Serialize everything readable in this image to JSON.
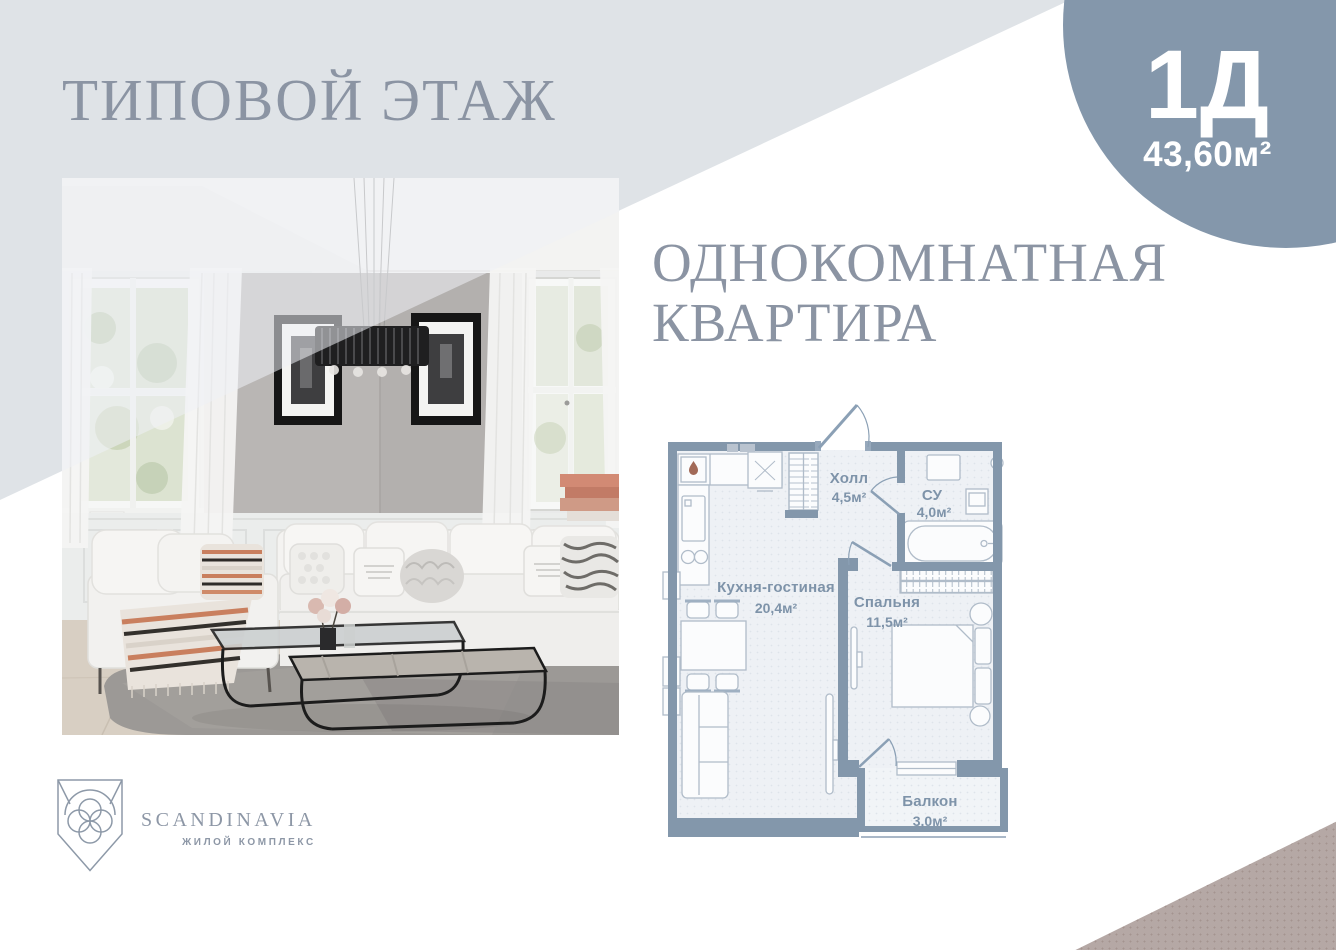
{
  "header": {
    "floor_title": "ТИПОВОЙ ЭТАЖ",
    "apartment_line1": "ОДНОКОМНАТНАЯ",
    "apartment_line2": "КВАРТИРА"
  },
  "badge": {
    "unit": "1Д",
    "area": "43,60м²"
  },
  "plan": {
    "rooms": [
      {
        "name": "Кухня-гостиная",
        "area": "20,4м²"
      },
      {
        "name": "Холл",
        "area": "4,5м²"
      },
      {
        "name": "СУ",
        "area": "4,0м²"
      },
      {
        "name": "Спальня",
        "area": "11,5м²"
      },
      {
        "name": "Балкон",
        "area": "3,0м²"
      }
    ]
  },
  "logo": {
    "name": "SCANDINAVIA",
    "tagline": "ЖИЛОЙ КОМПЛЕКС"
  },
  "colors": {
    "background_panel": "#dfe3e7",
    "badge_circle": "#8497ab",
    "title_text": "#8b94a3",
    "plan_walls": "#8397ab",
    "plan_floor": "#eef1f5",
    "plan_labels": "#7e93a9",
    "corner_triangle": "#b5a8a5"
  }
}
